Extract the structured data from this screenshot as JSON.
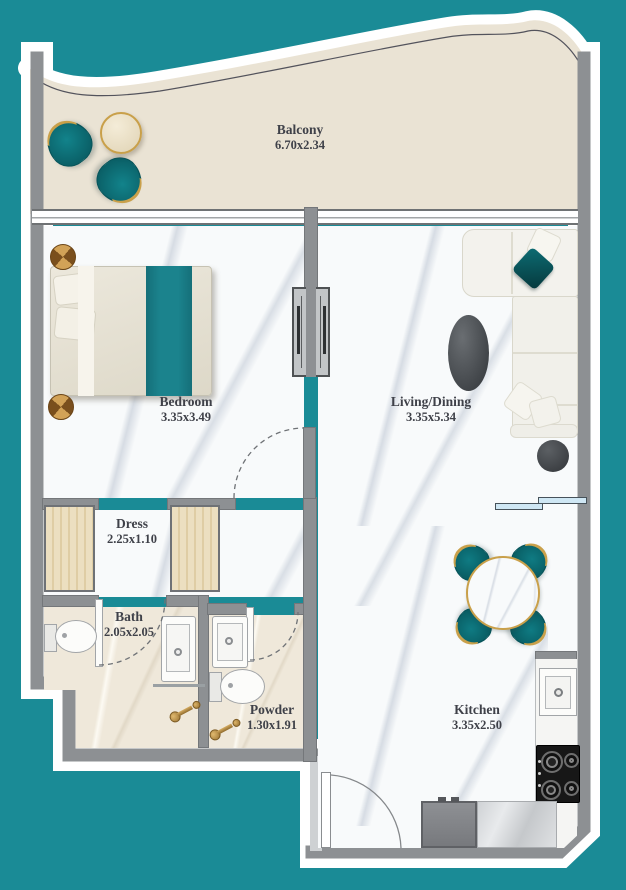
{
  "rooms": {
    "balcony": {
      "name": "Balcony",
      "dims": "6.70x2.34"
    },
    "bedroom": {
      "name": "Bedroom",
      "dims": "3.35x3.49"
    },
    "living_dining": {
      "name": "Living/Dining",
      "dims": "3.35x5.34"
    },
    "dress": {
      "name": "Dress",
      "dims": "2.25x1.10"
    },
    "bath": {
      "name": "Bath",
      "dims": "2.05x2.05"
    },
    "powder": {
      "name": "Powder",
      "dims": "1.30x1.91"
    },
    "kitchen": {
      "name": "Kitchen",
      "dims": "3.35x2.50"
    }
  },
  "colors": {
    "background_teal": "#1a8b96",
    "wall_gray": "#8d9093",
    "accent_teal_furniture": "#0d767c",
    "gold": "#c9a04a",
    "balcony_beige": "#eae3d4",
    "shelf_blue": "#cfe7f4"
  }
}
